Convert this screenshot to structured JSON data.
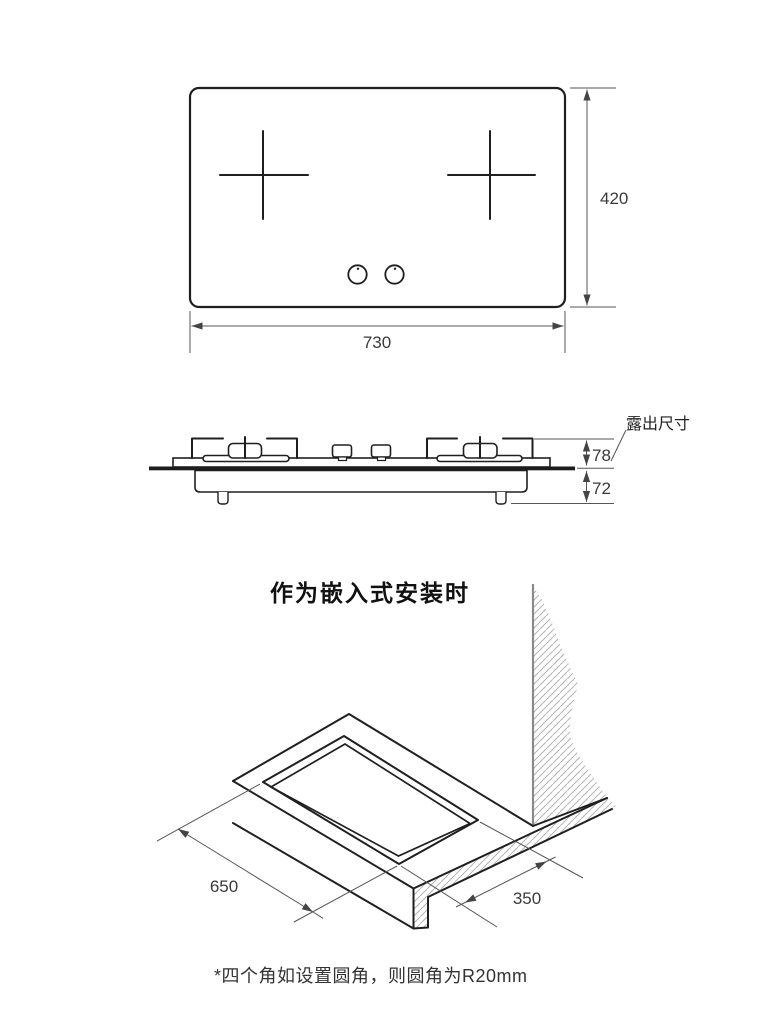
{
  "top_view": {
    "width_label": "730",
    "height_label": "420"
  },
  "side_view": {
    "callout_label": "露出尺寸",
    "above_counter_label": "78",
    "below_counter_label": "72"
  },
  "embedded_view": {
    "title": "作为嵌入式安装时",
    "cutout_length_label": "650",
    "cutout_depth_label": "350"
  },
  "footnote": "*四个角如设置圆角，则圆角为R20mm",
  "colors": {
    "line": "#1f1f1f",
    "dimension": "#555555",
    "dim_text": "#3a3a3a",
    "hatch": "#b3b3b3",
    "wall": "#8a8a8a",
    "background": "#ffffff"
  }
}
